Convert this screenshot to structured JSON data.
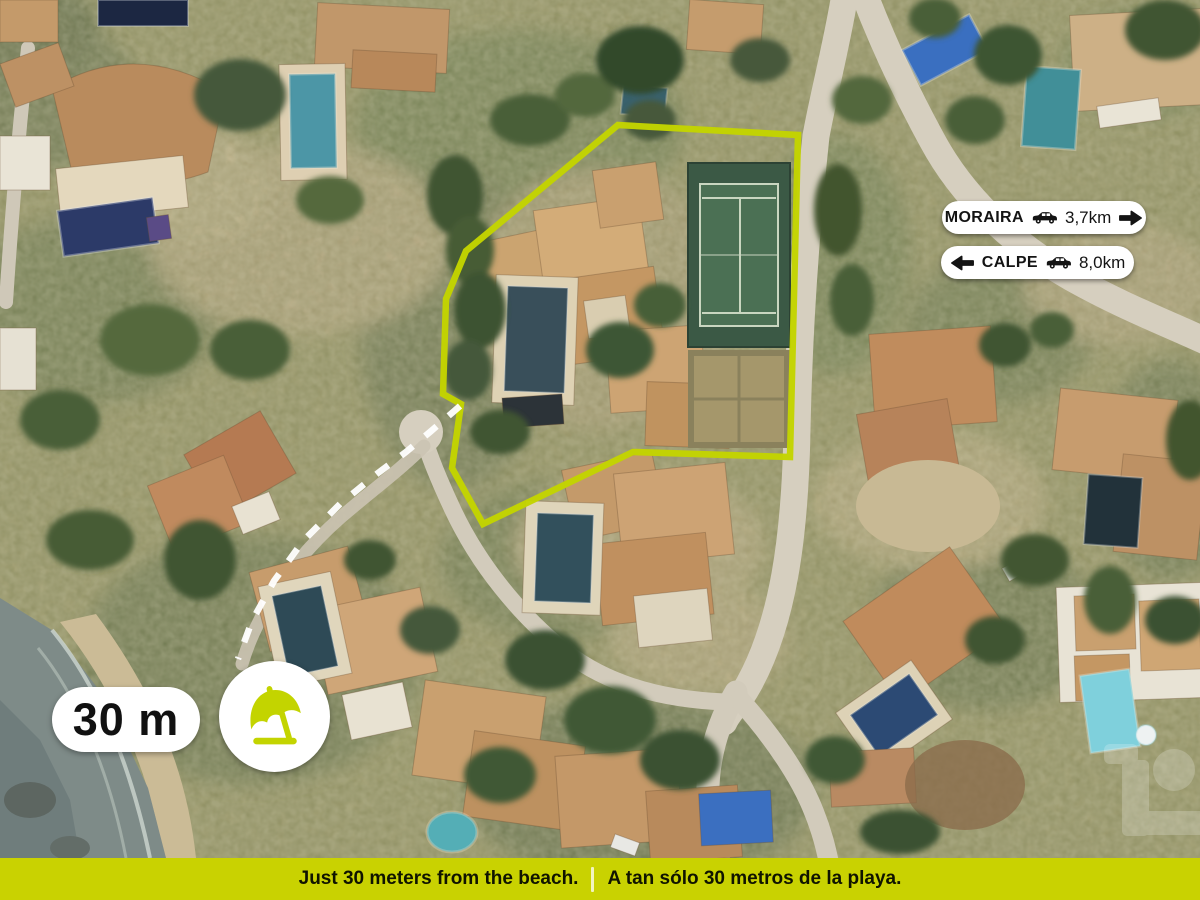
{
  "accent_color": "#c9d201",
  "map": {
    "kind": "aerial-satellite-photo",
    "overlays": {
      "property_outline_color": "#c3d400",
      "beach_route_style": "dashed-white",
      "features": [
        "villas",
        "swimming-pools",
        "tennis-court",
        "roads",
        "sea-shore"
      ]
    }
  },
  "direction_badges": [
    {
      "town": "MORAIRA",
      "distance": "3,7km",
      "vehicle_icon": "car-icon",
      "arrow_icon": "arrow-right-icon"
    },
    {
      "town": "CALPE",
      "distance": "8,0km",
      "vehicle_icon": "car-icon",
      "arrow_icon": "arrow-left-icon"
    }
  ],
  "beach_marker": {
    "distance_label": "30 m",
    "icon": "beach-umbrella-icon",
    "icon_color": "#c3d400"
  },
  "footer": {
    "background_color": "#c9d201",
    "text_en": "Just 30 meters from the beach.",
    "divider": "|",
    "text_es": "A tan sólo 30 metros de la playa."
  }
}
